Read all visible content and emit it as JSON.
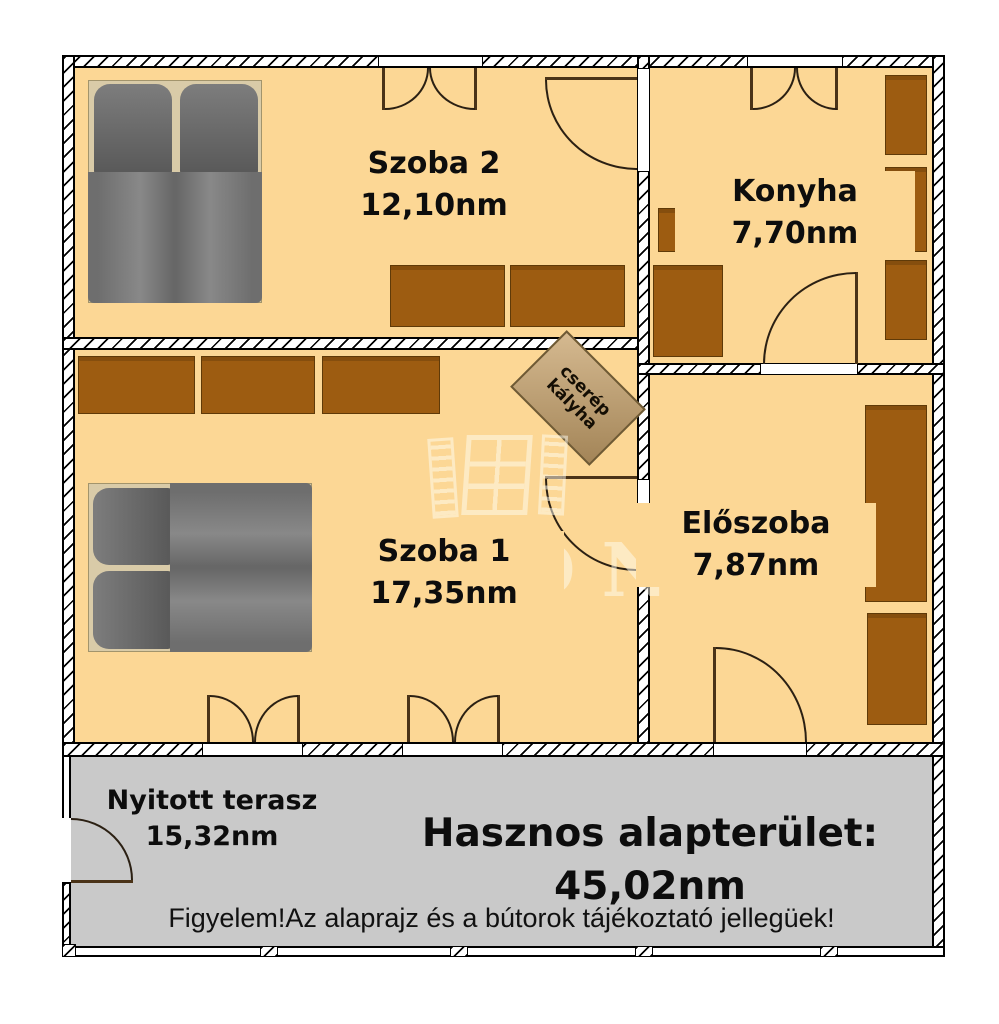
{
  "plan": {
    "rooms": {
      "szoba2": {
        "name": "Szoba 2",
        "area": "12,10nm"
      },
      "konyha": {
        "name": "Konyha",
        "area": "7,70nm"
      },
      "szoba1": {
        "name": "Szoba 1",
        "area": "17,35nm"
      },
      "eloszoba": {
        "name": "Előszoba",
        "area": "7,87nm"
      },
      "terasz": {
        "name": "Nyitott terasz",
        "area": "15,32nm"
      }
    },
    "stove": {
      "line1": "cserép",
      "line2": "kályha"
    },
    "summary": {
      "label": "Hasznos alapterület:",
      "value": "45,02nm"
    },
    "disclaimer": "Figyelem!Az alaprajz és a bútorok tájékoztató jellegüek!",
    "watermark": "GDN"
  },
  "colors": {
    "floor": "#fcd795",
    "terrace": "#c9c9c9",
    "furn": "#9d5c11",
    "furnb": "#5f3a08",
    "stove": "#c7a26b",
    "bedframe": "#d9cba8",
    "bedduvet": "#7b7b7b",
    "bedpillow": "#646464",
    "leaf": "#4a3318",
    "arcline": "#2b2013",
    "line": "#000000"
  }
}
